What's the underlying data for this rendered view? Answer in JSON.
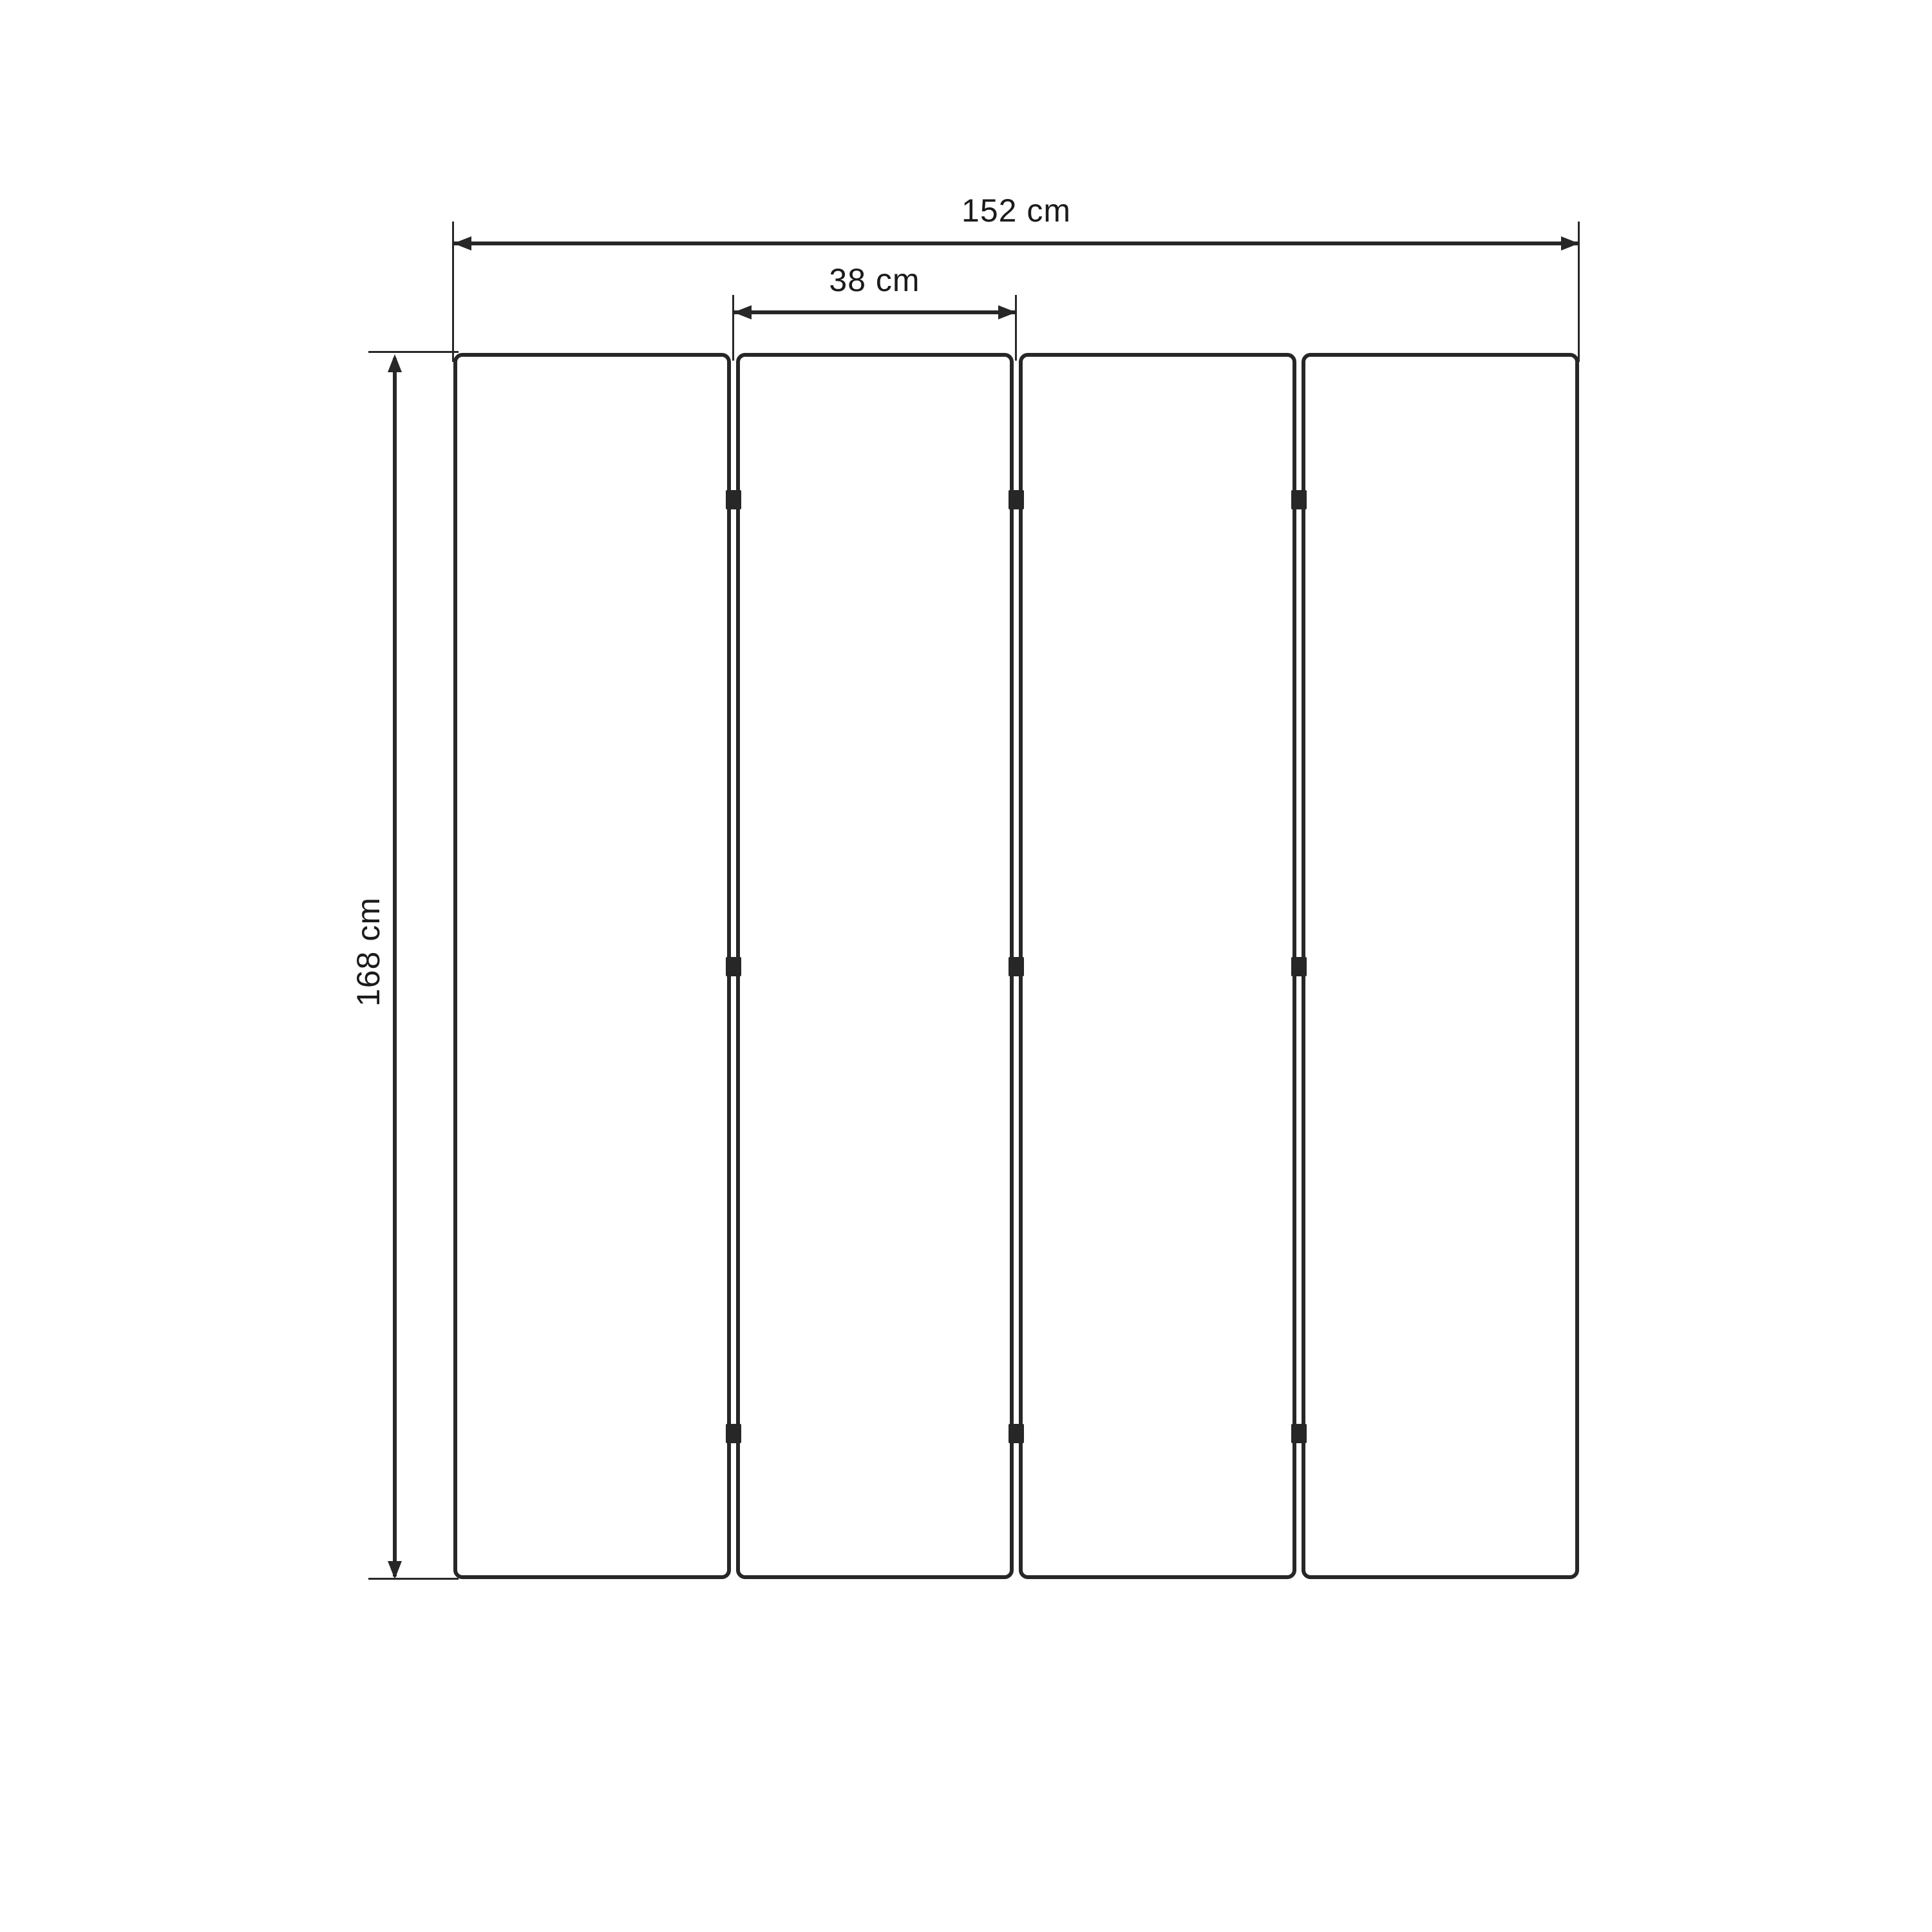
{
  "diagram": {
    "type": "dimension-drawing",
    "subject": "four-panel folding screen front view",
    "panel_count": 4,
    "colors": {
      "background": "#ffffff",
      "line": "#272727",
      "text": "#1b1b1b"
    },
    "dimensions": {
      "total_width": {
        "label": "152 cm"
      },
      "panel_width": {
        "label": "38 cm"
      },
      "height": {
        "label": "168 cm"
      }
    }
  }
}
